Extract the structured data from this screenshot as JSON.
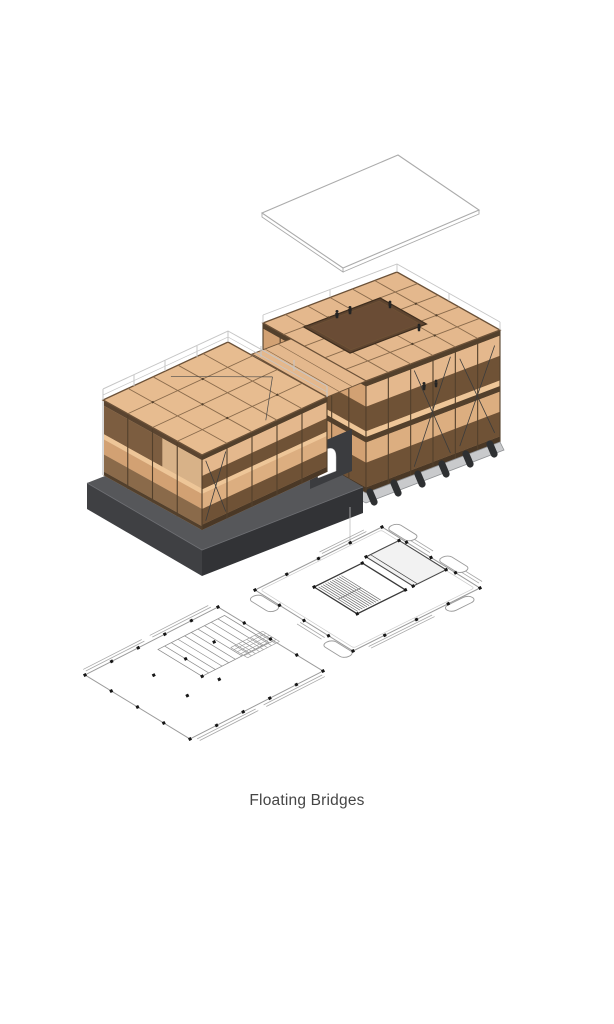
{
  "caption": {
    "text": "Floating Bridges"
  },
  "diagram": {
    "type": "exploded-axonometric-architecture",
    "parts": [
      "roof-plane",
      "timber-building-tall",
      "timber-building-low",
      "dark-plinth",
      "pontoons",
      "connecting-deck",
      "arch-opening",
      "upper-floor-plan",
      "lower-floor-plan"
    ]
  },
  "colors": {
    "background": "#ffffff",
    "wood_deck": "#e4b88d",
    "wood_deck_light": "#eec698",
    "wood_parapet": "#dcae80",
    "wood_parapet_shade": "#d2a173",
    "wood_mid": "#c89a6e",
    "wood_interior": "#6f5236",
    "wood_interior_dark": "#53402c",
    "wood_base": "#4a3826",
    "wood_outline": "#6b5138",
    "wood_beam": "#8a6b4c",
    "void_interior": "#5f4530",
    "void_ledge": "#6a4c35",
    "plinth_top": "#56575a",
    "plinth_side": "#3f4043",
    "plinth_side_dark": "#323336",
    "pontoon": "#2e3032",
    "pontoon_deck": "#c9cacc",
    "wireframe": "#ababab",
    "rail": "#c6c6c6",
    "rail_post": "#d9d9d9",
    "plan_line": "#9b9b9b",
    "plan_rail": "#a8a8a8",
    "plan_dark": "#3a3a3a",
    "plan_dot": "#161616",
    "stair_line": "#6e6e6e",
    "figure": "#242424",
    "arch_surround": "#3b3c3f",
    "brace": "#3c3c3c",
    "leader": "#bdbdbd",
    "caption_text": "#454545"
  }
}
